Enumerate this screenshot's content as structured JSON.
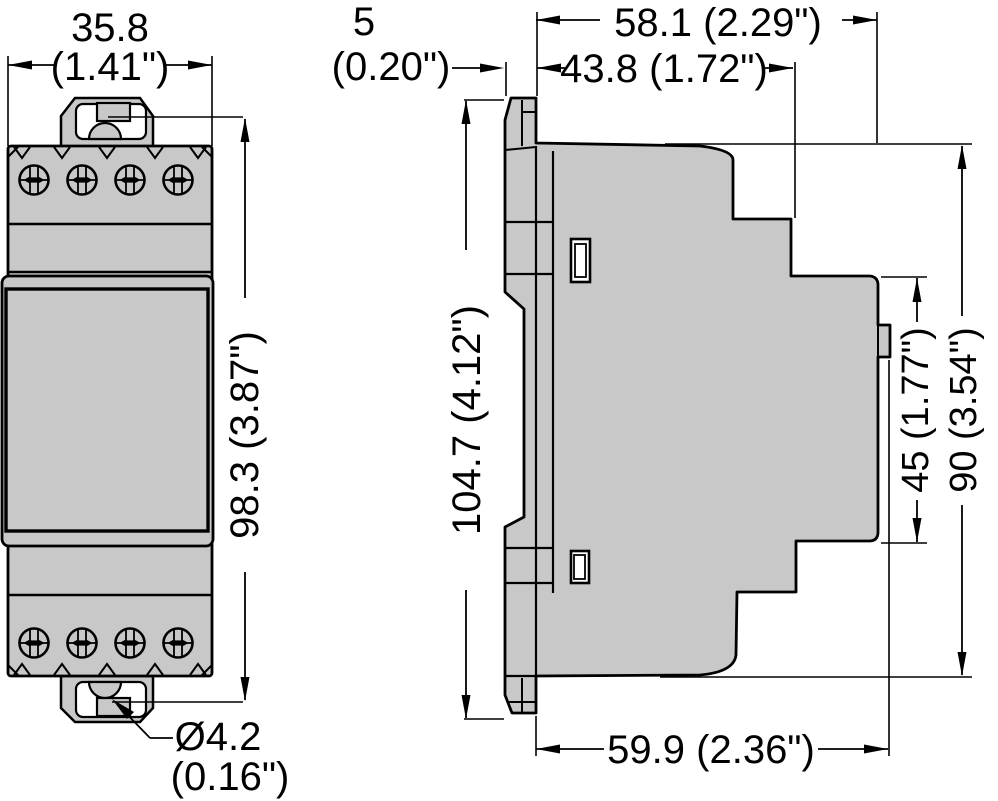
{
  "colors": {
    "body_fill": "#c8c8c8",
    "outline": "#000000",
    "background": "#ffffff"
  },
  "front_view": {
    "name": "front-view",
    "width_mm": "35.8",
    "width_in": "(1.41\")",
    "height_label": "98.3 (3.87\")",
    "hole_diameter_mm": "Ø4.2",
    "hole_diameter_in": "(0.16\")"
  },
  "side_view": {
    "name": "side-view",
    "terminal_protrusion_mm": "5",
    "terminal_protrusion_in": "(0.20\")",
    "depth_total_label": "58.1 (2.29\")",
    "depth_upper_label": "43.8 (1.72\")",
    "height_total_label": "104.7 (4.12\")",
    "height_rear_label": "45 (1.77\")",
    "height_body_label": "90 (3.54\")",
    "depth_bottom_label": "59.9 (2.36\")"
  }
}
